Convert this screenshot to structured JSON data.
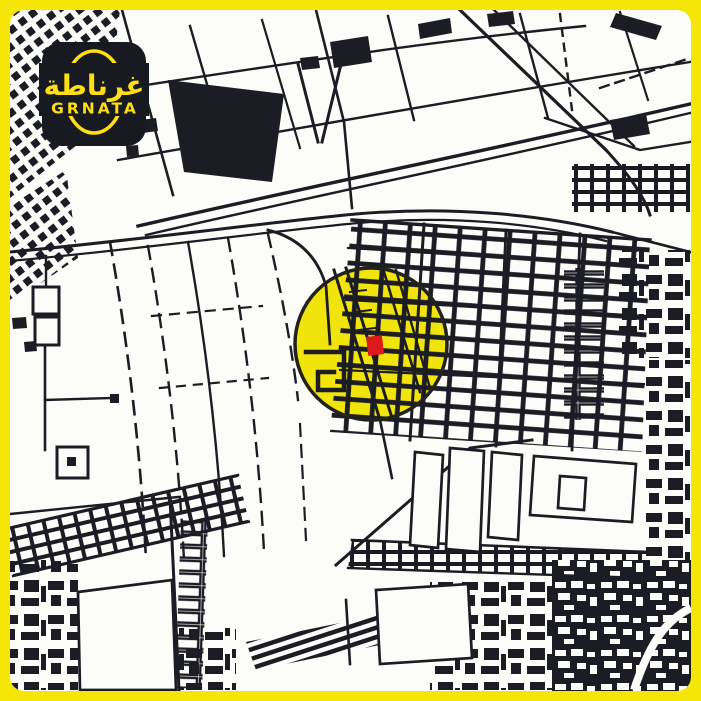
{
  "brand": {
    "logo": {
      "arabic_name": "غرناطة",
      "latin_name": "GRNATA",
      "background_color": "#171A21",
      "accent_color": "#FFDE14"
    }
  },
  "frame": {
    "border_color": "#F5E607"
  },
  "map": {
    "style": "monochrome-sketch-street-map",
    "background_color": "#FCFCF9",
    "ink_color": "#1C1C25",
    "highlight": {
      "shape": "circle",
      "fill_color": "#F0E40A",
      "outline_color": "#22221A",
      "center_x": 371,
      "center_y": 344,
      "radius": 76
    },
    "marker": {
      "color": "#DC191D",
      "x": 367,
      "y": 336,
      "width": 16,
      "height": 19
    }
  }
}
